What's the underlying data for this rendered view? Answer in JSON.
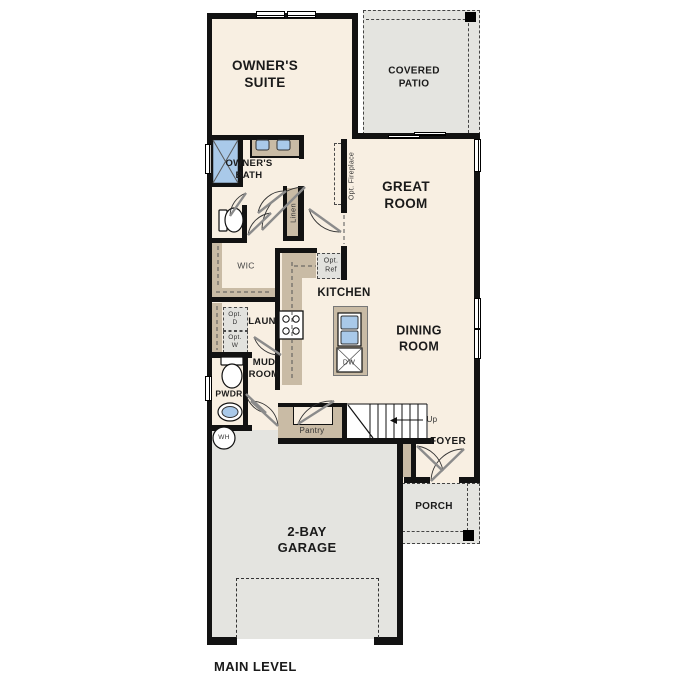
{
  "title": "MAIN LEVEL",
  "rooms": {
    "owners_suite": "OWNER'S\nSUITE",
    "covered_patio": "COVERED\nPATIO",
    "owners_bath": "OWNER'S\nBATH",
    "great_room": "GREAT\nROOM",
    "wic": "WIC",
    "kitchen": "KITCHEN",
    "laundry": "LAUN",
    "mud_room": "MUD\nROOM",
    "dining_room": "DINING\nROOM",
    "powder": "PWDR",
    "foyer": "FOYER",
    "porch": "PORCH",
    "garage": "2-BAY\nGARAGE"
  },
  "closets": {
    "linen": "Linen",
    "pantry": "Pantry"
  },
  "options": {
    "fireplace": "Opt. Fireplace",
    "refrigerator": "Opt.\nRef",
    "dryer": "Opt.\nD",
    "washer": "Opt.\nW"
  },
  "appliances": {
    "dishwasher": "DW",
    "water_heater": "WH"
  },
  "stairs": {
    "up_label": "Up"
  },
  "colors": {
    "floor": "#f8efe2",
    "outdoor": "#e4e4e0",
    "cabinet": "#c9bba5",
    "fixture_blue": "#a9c9e9",
    "wall": "#121212"
  }
}
